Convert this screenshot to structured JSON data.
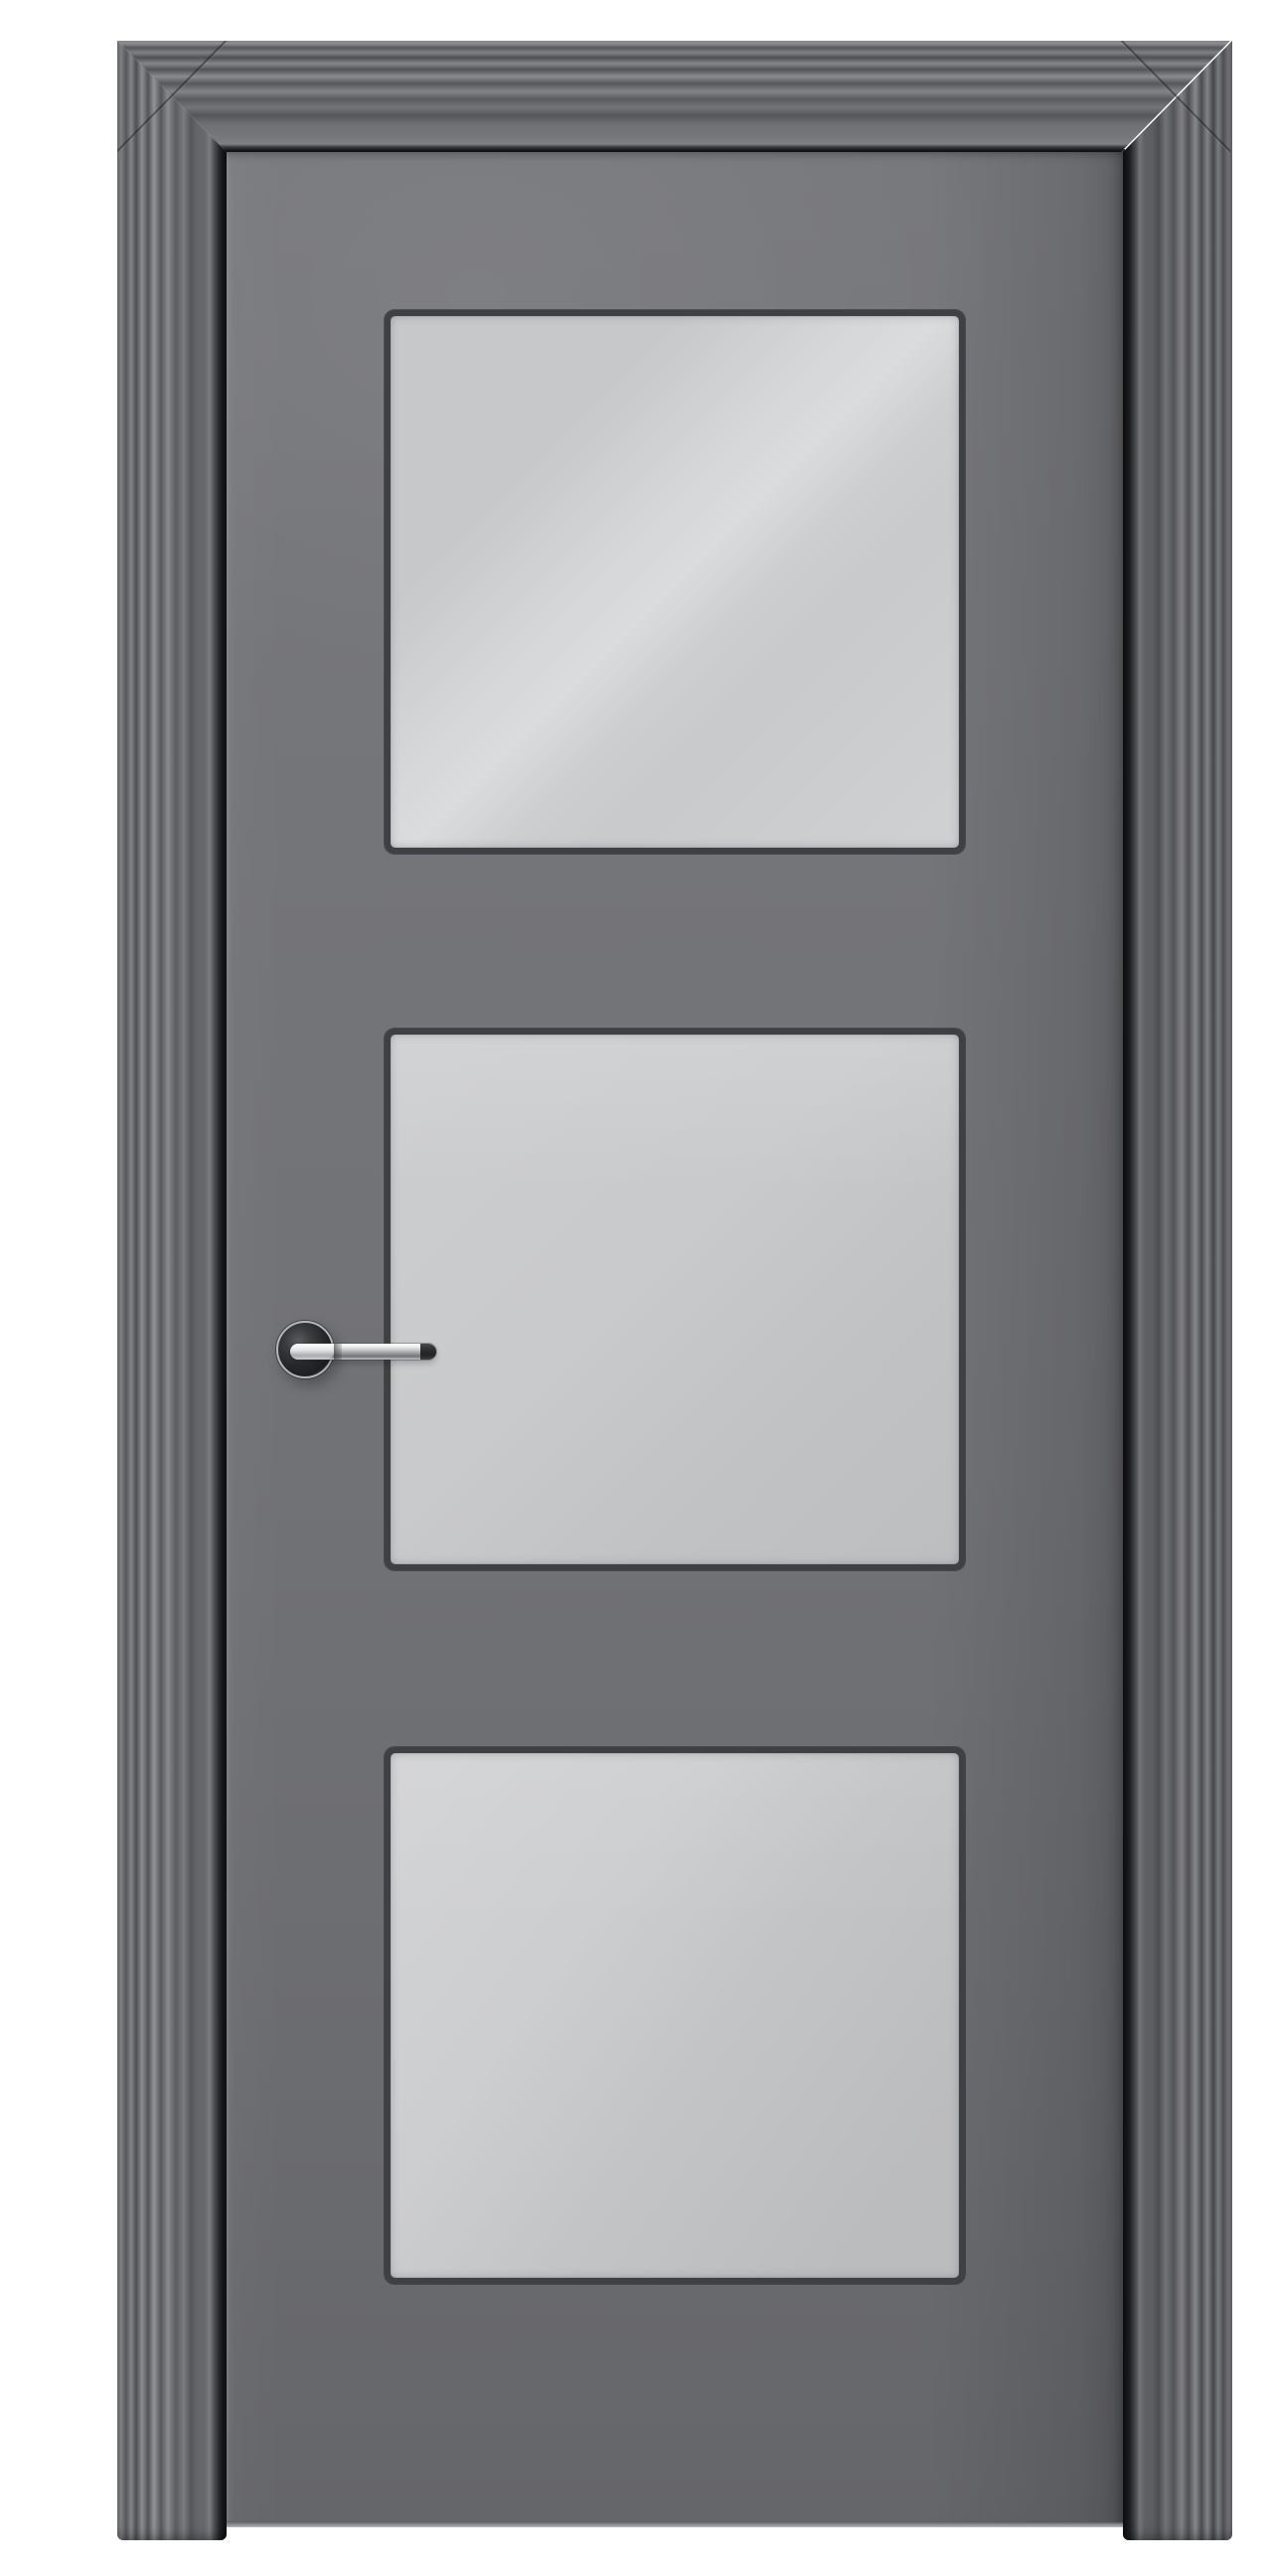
{
  "scene": {
    "description": "Product photo of a matte gray interior door in a stepped molded frame, with three square frosted glass panels stacked vertically and a polished chrome lever handle on a round rose at mid-height on the left stile.",
    "background_color": "#ffffff"
  },
  "door": {
    "style": "three-panel glazed interior door",
    "finish": "matte gray paint",
    "panel_count": 3,
    "panels": [
      {
        "id": "top",
        "glazing": "frosted glass",
        "reflection": "bright diagonal streak running lower-left to upper-right"
      },
      {
        "id": "middle",
        "glazing": "frosted glass",
        "reflection": "soft, nearly uniform with slight top brightening"
      },
      {
        "id": "bottom",
        "glazing": "frosted glass",
        "reflection": "lighter upper-left wedge fading darker to lower-right"
      }
    ],
    "handle": {
      "type": "straight lever on round rose",
      "finish": "polished chrome",
      "tip": "dark rubber-like end cap",
      "position": "left stile, mid-height, lever pointing right over the middle pane edge"
    },
    "frame": {
      "type": "architrave casing with stepped ribbed molding",
      "mitered_corners": true,
      "legs_run_to_floor": true
    }
  },
  "colors": {
    "background": "#ffffff",
    "frame_base": "#616266",
    "leaf": "#717276",
    "bead": "#3f4043",
    "glass": "#c7c8ca",
    "chrome_light": "#fbfcfd",
    "chrome_mid": "#97989b",
    "chrome_dark": "#737477",
    "handle_tip": "#222325",
    "rose_face": "#26272a"
  }
}
